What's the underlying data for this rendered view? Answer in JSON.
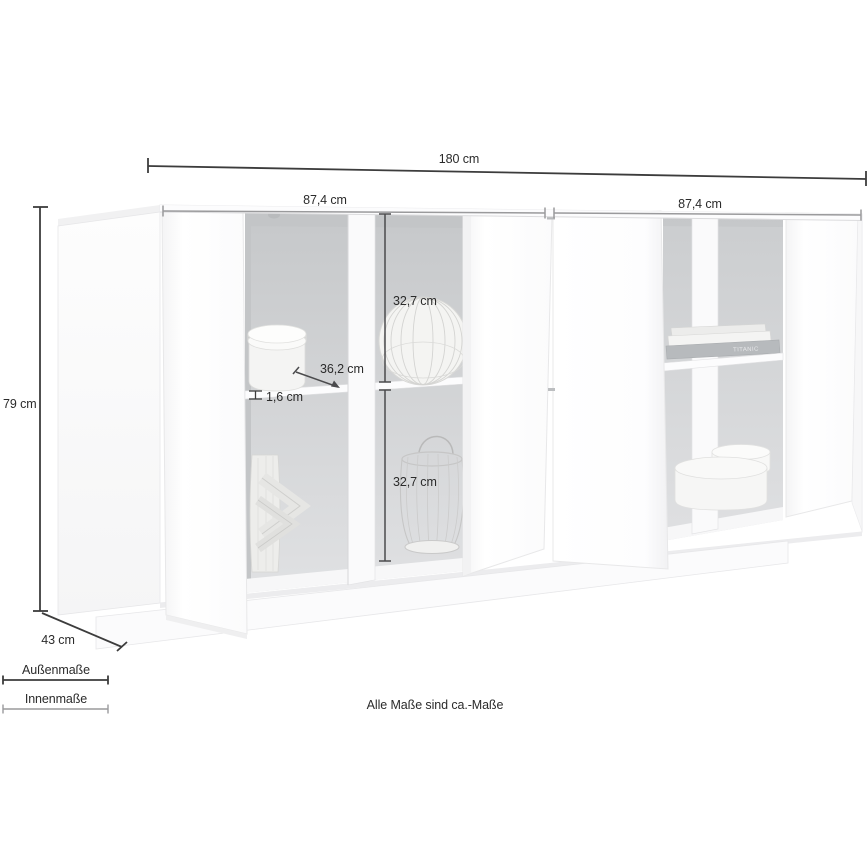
{
  "diagram": {
    "product": "sideboard",
    "note": "Alle Maße sind ca.-Maße"
  },
  "dimensions": {
    "outer_width": "180 cm",
    "inner_width_left": "87,4 cm",
    "inner_width_right": "87,4 cm",
    "outer_height": "79 cm",
    "outer_depth": "43 cm",
    "inner_height_upper": "32,7 cm",
    "inner_height_lower": "32,7 cm",
    "inner_depth": "36,2 cm",
    "shelf_thickness": "1,6 cm"
  },
  "legend": {
    "outer_label": "Außenmaße",
    "inner_label": "Innenmaße"
  },
  "decor": {
    "book_spine_title": "TITANIC"
  },
  "colors": {
    "outer_dimension_line": "#3c3c3c",
    "inner_dimension_line": "#9a9a9c",
    "mid_dimension_line": "#4b4b4d",
    "label_text": "#2b2b2b",
    "interior_back_panel": "#ced0d2",
    "cabinet": "#ffffff"
  }
}
